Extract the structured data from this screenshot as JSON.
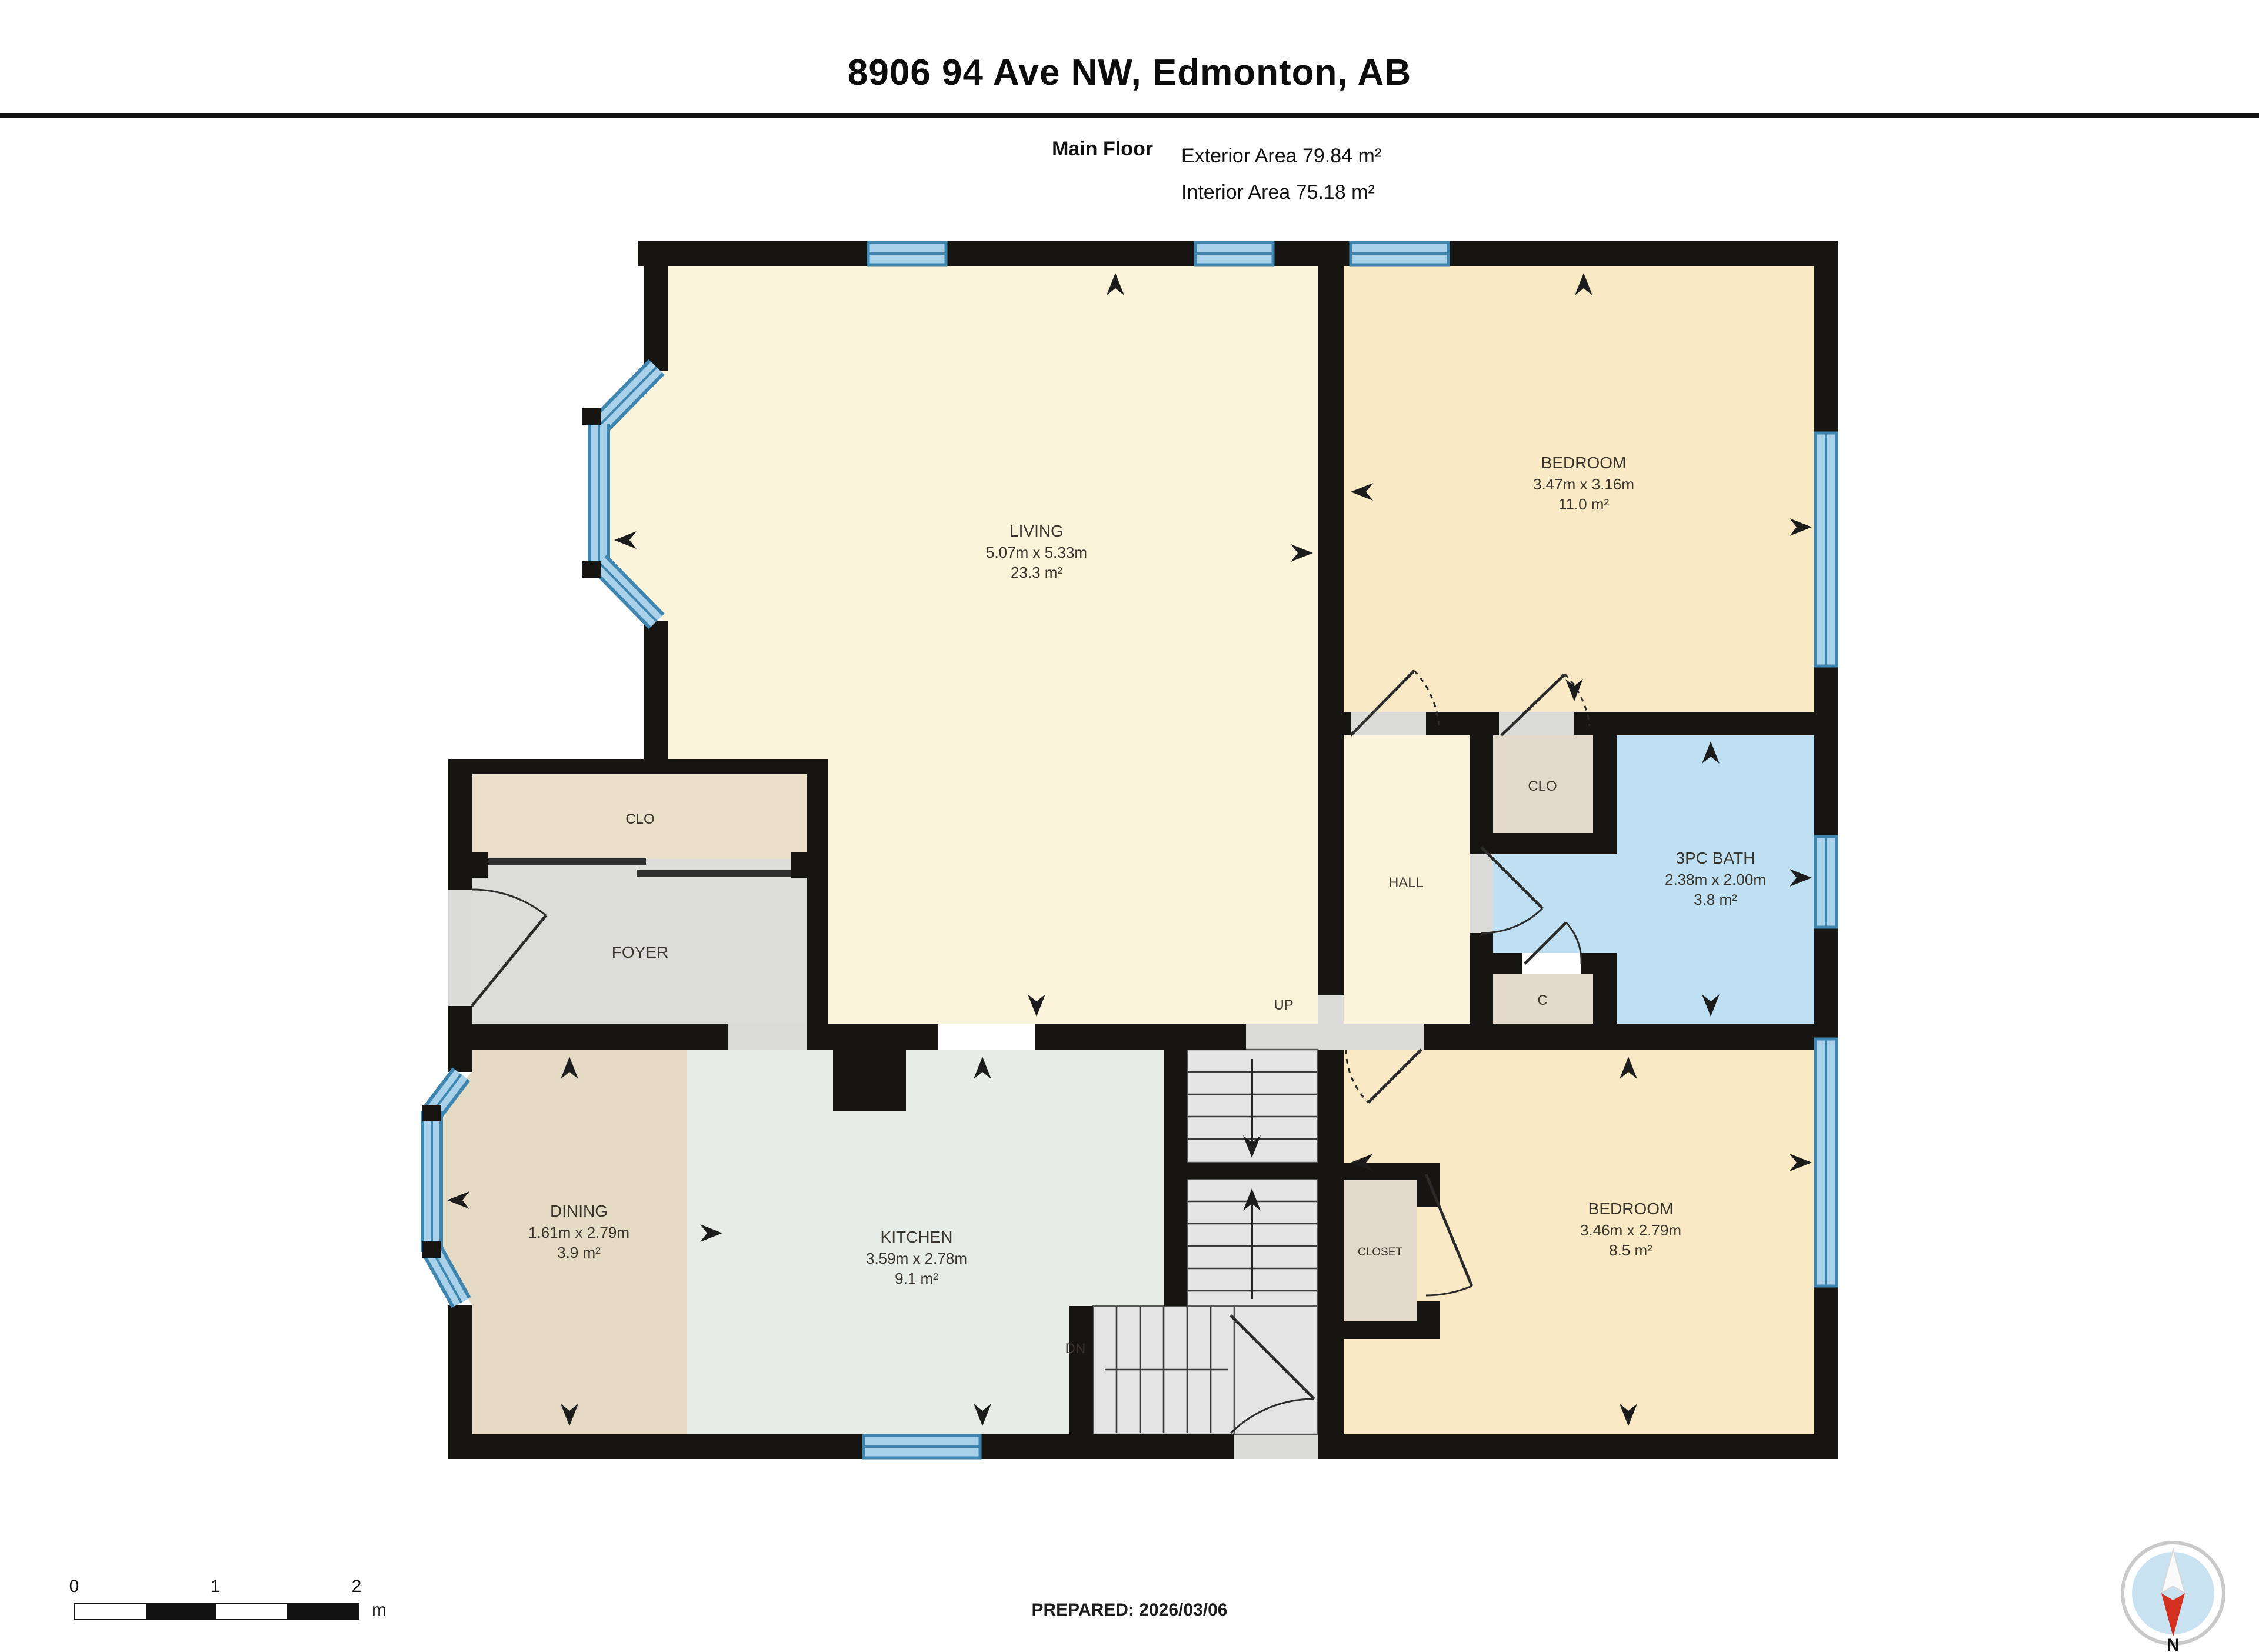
{
  "header": {
    "title": "8906 94 Ave NW, Edmonton, AB",
    "floor_label": "Main Floor",
    "exterior_area": "Exterior Area 79.84 m²",
    "interior_area": "Interior Area 75.18 m²"
  },
  "rooms": {
    "living": {
      "name": "LIVING",
      "dims": "5.07m x 5.33m",
      "area": "23.3 m²"
    },
    "bedroom1": {
      "name": "BEDROOM",
      "dims": "3.47m x 3.16m",
      "area": "11.0 m²"
    },
    "bath": {
      "name": "3PC BATH",
      "dims": "2.38m x 2.00m",
      "area": "3.8 m²"
    },
    "bedroom2": {
      "name": "BEDROOM",
      "dims": "3.46m x 2.79m",
      "area": "8.5 m²"
    },
    "dining": {
      "name": "DINING",
      "dims": "1.61m x 2.79m",
      "area": "3.9 m²"
    },
    "kitchen": {
      "name": "KITCHEN",
      "dims": "3.59m x 2.78m",
      "area": "9.1 m²"
    },
    "hall": {
      "name": "HALL"
    },
    "foyer": {
      "name": "FOYER"
    },
    "clo_foyer": {
      "name": "CLO"
    },
    "clo_bedroom": {
      "name": "CLO"
    },
    "c_closet": {
      "name": "C"
    },
    "closet": {
      "name": "CLOSET"
    }
  },
  "stairs": {
    "up": "UP",
    "down": "DN"
  },
  "scale_bar": {
    "tick0": "0",
    "tick1": "1",
    "tick2": "2",
    "unit": "m"
  },
  "compass": {
    "north": "N"
  },
  "footer": {
    "prepared": "PREPARED: 2026/03/06"
  },
  "colors": {
    "wall": "#171512",
    "living": "#FCF4DA",
    "bedroom": "#F9E9C5",
    "bath": "#BEE0F2",
    "dining": "#E5DAC3",
    "kitchen": "#E7EDE6",
    "foyer": "#DCDCDA",
    "closet_beige": "#EADFCB",
    "closet_gray": "#E3DACB",
    "stairs": "#E4E4E4",
    "window": "#A9D2EA",
    "window_frame": "#3E85B0",
    "accent_red": "#D3301F"
  }
}
